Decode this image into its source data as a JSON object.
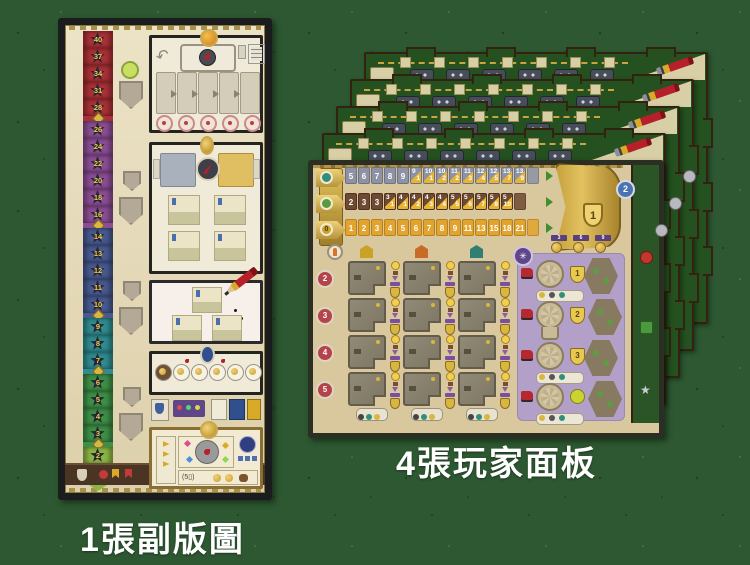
{
  "captions": {
    "sub_board": "1張副版圖",
    "player_boards": "4張玩家面板"
  },
  "colors": {
    "background": "#2d5831",
    "parchment": "#d9c79d",
    "board_back_green": "#24511f",
    "gold": "#d9b84f",
    "track_gray": "#8d93a4",
    "track_brown": "#6f4a33",
    "track_gold": "#e2a42e",
    "split_gold": "#e8b433",
    "purple_panel": "#b2a0c9",
    "score_red": "#a93036",
    "score_purple": "#8a4d92",
    "score_blue": "#47598f",
    "score_teal": "#2f8b8f",
    "score_green": "#3d8f46",
    "score_lightgreen": "#8cb544"
  },
  "score_track": {
    "sections": [
      {
        "name": "red",
        "color": "#a93036",
        "values": [
          "40",
          "37",
          "34",
          "31",
          "28"
        ]
      },
      {
        "name": "purple",
        "color": "#8a4d92",
        "values": [
          "26",
          "24",
          "22",
          "20",
          "18",
          "16"
        ]
      },
      {
        "name": "blue",
        "color": "#47598f",
        "values": [
          "14",
          "13",
          "12",
          "11",
          "10"
        ]
      },
      {
        "name": "teal",
        "color": "#2f8b8f",
        "values": [
          "9",
          "8",
          "7"
        ]
      },
      {
        "name": "green",
        "color": "#3d8f46",
        "values": [
          "6",
          "5",
          "4",
          "3"
        ]
      },
      {
        "name": "lightgreen",
        "color": "#8cb544",
        "values": [
          "2",
          "1"
        ]
      }
    ],
    "bottom_label": "(5▯)"
  },
  "player_board": {
    "tracks": [
      {
        "name": "gray-track",
        "cell_color": "#8d93a4",
        "border_color": "#6d7384",
        "plain": [
          "5",
          "6",
          "7",
          "8",
          "9"
        ],
        "split": [
          [
            "9",
            "1"
          ],
          [
            "10",
            "1"
          ],
          [
            "10",
            "2"
          ],
          [
            "11",
            "2"
          ],
          [
            "11",
            "3"
          ],
          [
            "12",
            "4"
          ],
          [
            "12",
            "5"
          ],
          [
            "13",
            "7"
          ],
          [
            "13",
            "9"
          ]
        ]
      },
      {
        "name": "brown-track",
        "cell_color": "#6f4a33",
        "border_color": "#4f3222",
        "plain": [
          "2",
          "3",
          "3"
        ],
        "split": [
          [
            "3",
            "1"
          ],
          [
            "4",
            "1"
          ],
          [
            "4",
            "2"
          ],
          [
            "4",
            "3"
          ],
          [
            "4",
            "4"
          ],
          [
            "5",
            "5"
          ],
          [
            "5",
            "6"
          ],
          [
            "5",
            "7"
          ],
          [
            "5",
            "8"
          ],
          [
            "5",
            "10"
          ]
        ]
      },
      {
        "name": "gold-track",
        "cell_color": "#e2a42e",
        "border_color": "#b5821f",
        "plain": [
          "1",
          "2",
          "3",
          "4",
          "5",
          "6",
          "7",
          "8",
          "9",
          "11",
          "13",
          "15",
          "18",
          "21"
        ],
        "split": []
      }
    ],
    "gold_tab_value": "0",
    "bracket_value": "1",
    "medallions": [
      "3",
      "6",
      "9"
    ],
    "row_badges": [
      "2",
      "3",
      "4",
      "5"
    ],
    "purple_shield_values": [
      "1",
      "2",
      "3"
    ],
    "coin_value": "2",
    "grid": {
      "columns": 3,
      "rows": 4
    }
  },
  "back_boards": {
    "count": 4,
    "squares_per_strip": 7,
    "wagons_per_strip": 6
  },
  "icons": {
    "pencil-icon": "red pencil on board corner",
    "wagon-icon": "gray train wagon",
    "clock-icon": "dark dial with red bird",
    "compass-icon": "dark dial with red needle",
    "bird-icon": "red pigeon",
    "medal-icon": "gold medal",
    "engine-icon": "red locomotive",
    "rosette-slot": "round rosette space",
    "worker-icon": "orange figure",
    "bulb-icon": "yellow light bulb",
    "star-icon": "silver star",
    "shield-icon": "gold shield"
  }
}
